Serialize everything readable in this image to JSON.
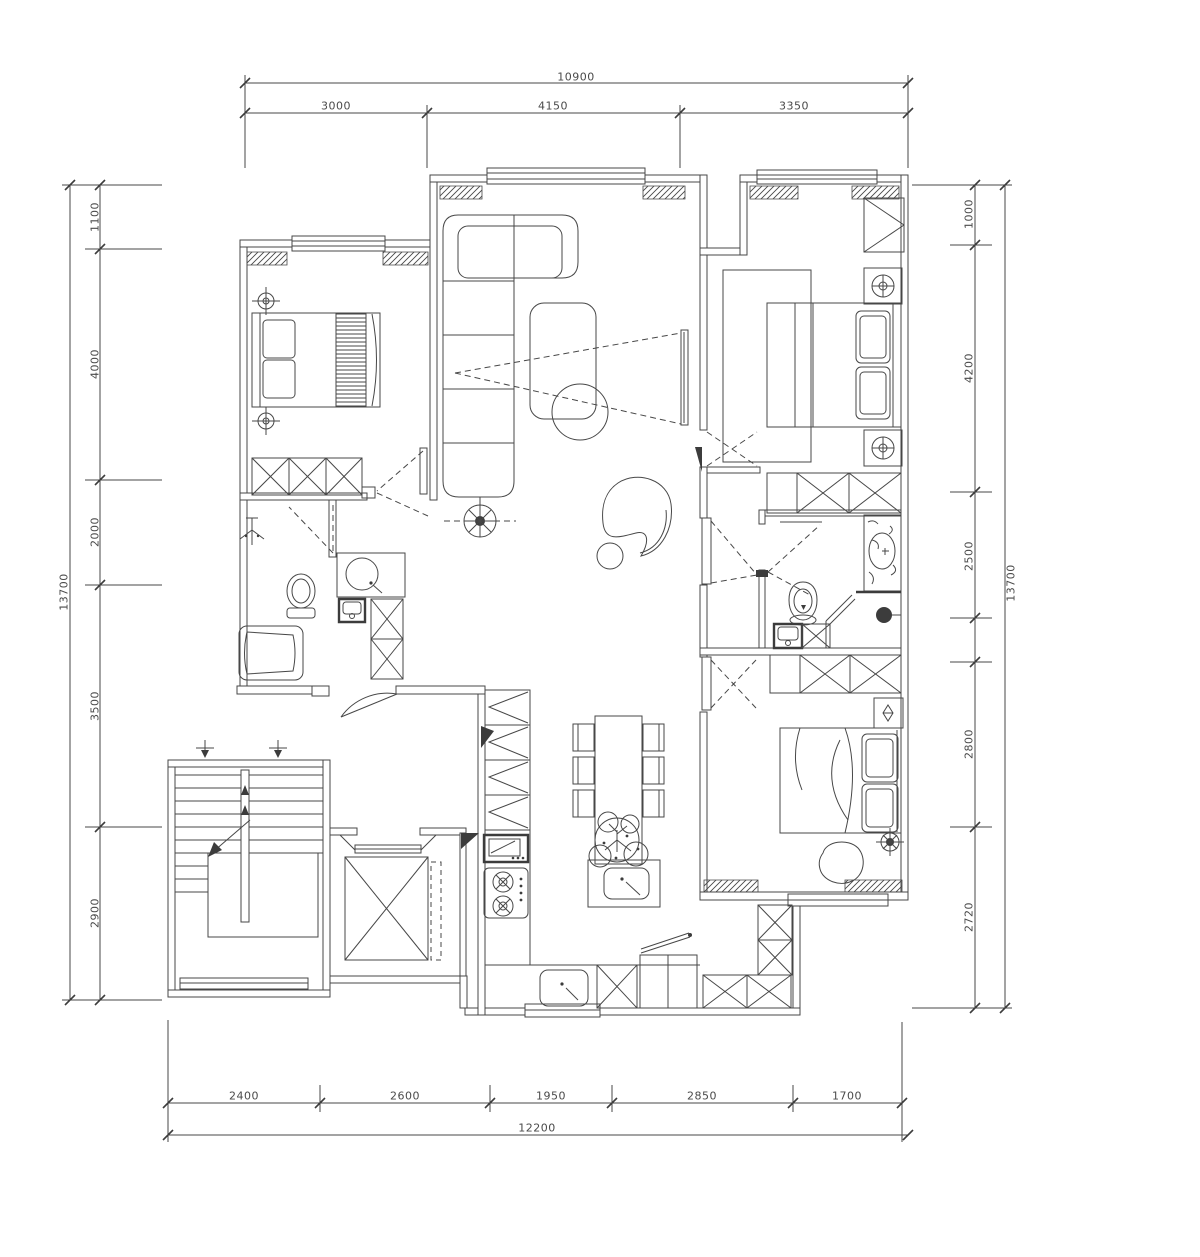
{
  "meta": {
    "background": "#ffffff",
    "line_color": "#474747",
    "text_color": "#4a4a4a"
  },
  "dimensions": {
    "top": {
      "total": "10900",
      "segments": [
        "3000",
        "4150",
        "3350"
      ]
    },
    "bottom": {
      "total": "12200",
      "segments": [
        "2400",
        "2600",
        "1950",
        "2850",
        "1700"
      ]
    },
    "left": {
      "total": "13700",
      "segments": [
        "1100",
        "4000",
        "2000",
        "3500",
        "2900"
      ]
    },
    "right": {
      "total": "13700",
      "segments": [
        "1000",
        "4200",
        "2500",
        "2800",
        "2720"
      ]
    }
  },
  "plan_elements": [
    "double-bed",
    "wardrobe",
    "sofa",
    "coffee-table",
    "tv",
    "floor-lamp",
    "armchair",
    "dining-table",
    "plant",
    "kitchen-island",
    "sink",
    "gas-cooktop",
    "microwave",
    "refrigerator",
    "bathtub",
    "toilet",
    "shower",
    "washing-machine",
    "vanity-basin",
    "staircase",
    "elevator"
  ]
}
